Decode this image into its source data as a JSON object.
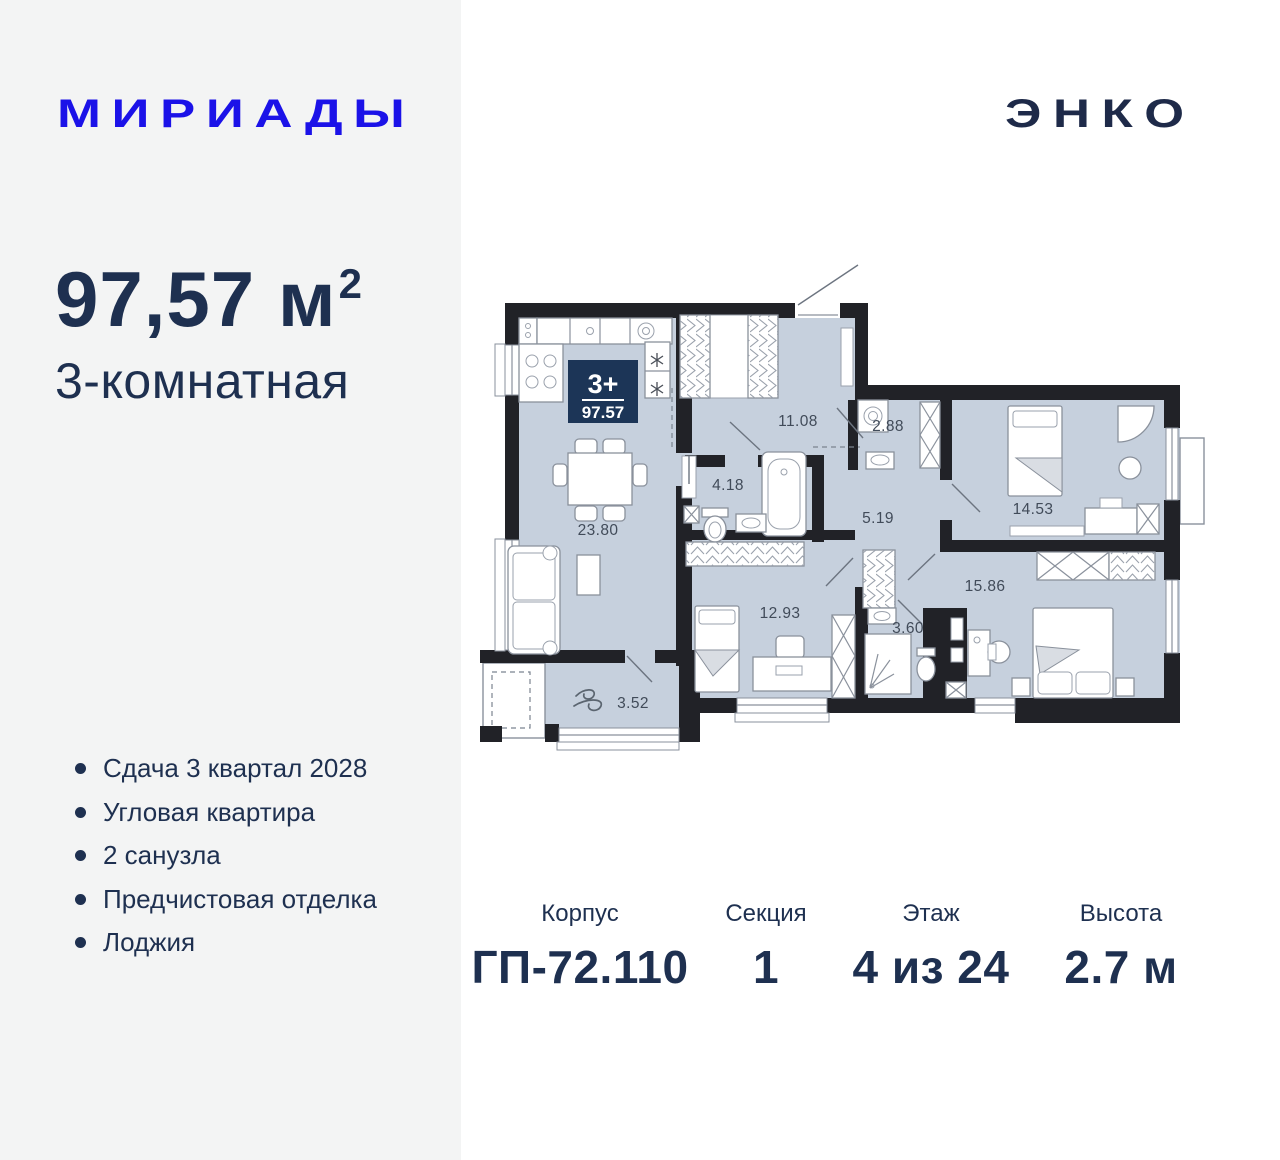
{
  "header": {
    "project_logo": "МИРИАДЫ",
    "developer_logo": "ЭНКО"
  },
  "left_panel": {
    "area_value": "97,57 м",
    "area_sup": "2",
    "room_type": "3-комнатная",
    "features": [
      "Сдача 3 квартал 2028",
      "Угловая квартира",
      "2 санузла",
      "Предчистовая отделка",
      "Лоджия"
    ]
  },
  "plan": {
    "badge": {
      "rooms_label": "3+",
      "area": "97.57"
    },
    "rooms": [
      {
        "id": "kitchen-living",
        "area": "23.80"
      },
      {
        "id": "hall",
        "area": "11.08"
      },
      {
        "id": "wardrobe",
        "area": "2.88"
      },
      {
        "id": "bathroom",
        "area": "4.18"
      },
      {
        "id": "corridor",
        "area": "5.19"
      },
      {
        "id": "bedroom-1",
        "area": "14.53"
      },
      {
        "id": "bedroom-2",
        "area": "15.86"
      },
      {
        "id": "bedroom-3",
        "area": "12.93"
      },
      {
        "id": "shower-room",
        "area": "3.60"
      },
      {
        "id": "loggia",
        "area": "3.52"
      }
    ],
    "colors": {
      "floor": "#c6d0dd",
      "wall": "#212227",
      "badge": "#1c3557",
      "accent_blue": "#1b12e8",
      "navy": "#1e3050"
    }
  },
  "info": {
    "columns": [
      {
        "label": "Корпус",
        "value": "ГП-72.110"
      },
      {
        "label": "Секция",
        "value": "1"
      },
      {
        "label": "Этаж",
        "value": "4 из 24"
      },
      {
        "label": "Высота",
        "value": "2.7 м"
      }
    ]
  }
}
